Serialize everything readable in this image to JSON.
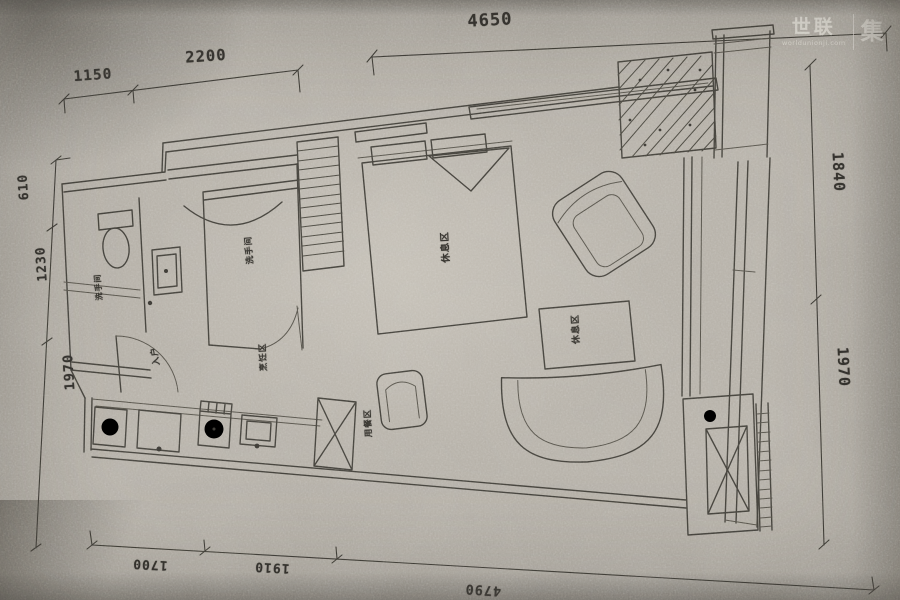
{
  "watermark": {
    "brand": "世联",
    "domain": "worldunionji.com",
    "collection": "集"
  },
  "dimensions": {
    "top": {
      "overall": "4650",
      "segment1": "1150",
      "segment2": "2200"
    },
    "left": {
      "d1": "610",
      "d2": "1230",
      "d3": "1970"
    },
    "right": {
      "d1": "1840",
      "d2": "1970"
    },
    "bottom": {
      "d1": "1700",
      "d2": "1910",
      "overall": "4790"
    }
  },
  "labels": {
    "bathroom1": "洗手间",
    "bathroom2": "洗手间",
    "sleeping": "休息区",
    "lounge": "休息区",
    "entry": "入户",
    "kitchen": "烹饪区",
    "dining": "用餐区"
  },
  "colors": {
    "paper": "#b5b0a7",
    "ink": "#43413b"
  }
}
